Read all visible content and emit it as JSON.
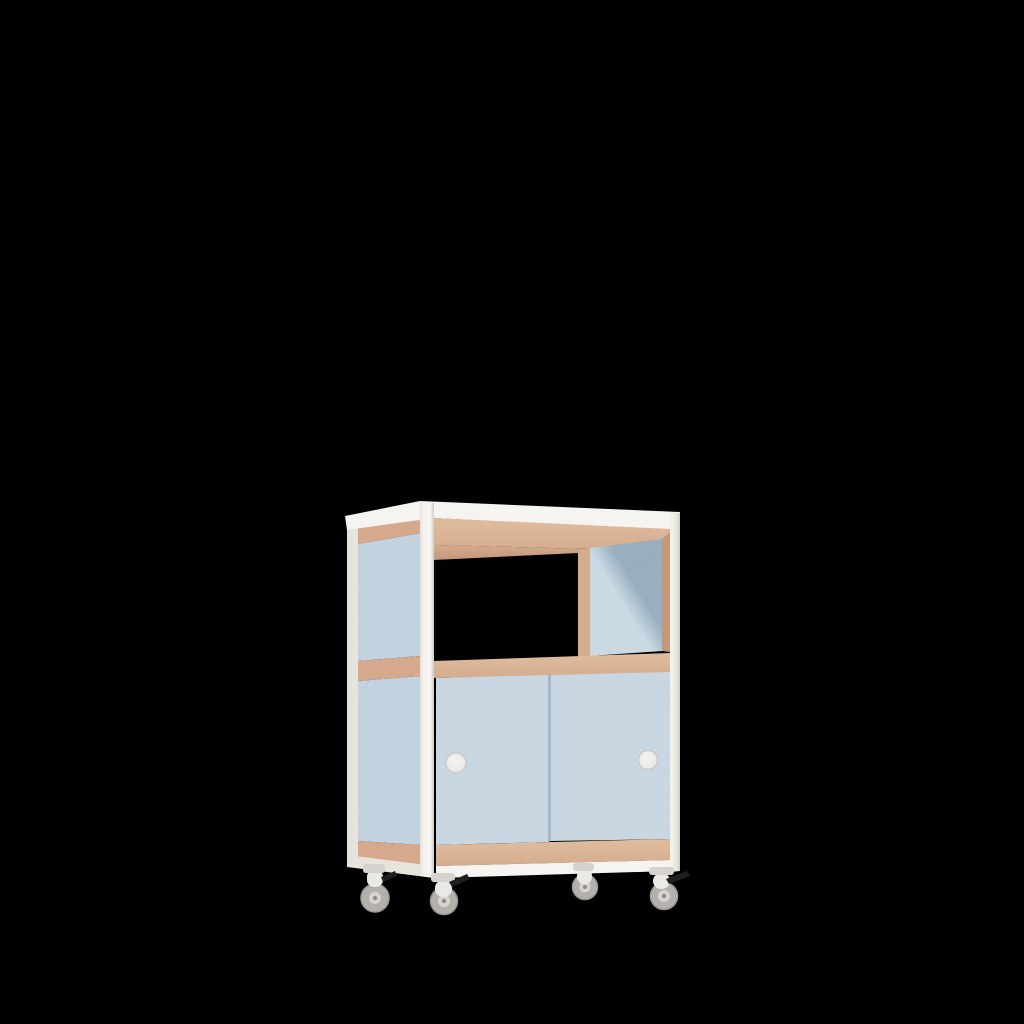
{
  "scene": {
    "background": "#000000",
    "object_name": "mobile cabinet with sliding doors on casters",
    "handle_count": 2,
    "caster_count": 4,
    "brake_count": 3
  },
  "colors": {
    "background": "#000000",
    "frame_white": "#f6f4f1",
    "frame_white_shade": "#e7e3dd",
    "frame_edge_dark": "#cfc9c1",
    "plywood_light": "#e0bda0",
    "plywood_mid": "#d5ac8e",
    "plywood_dark": "#c3977a",
    "plywood_side": "#d6a98c",
    "panel_side_blue": "#c3d3e0",
    "door_blue": "#c9d8e3",
    "door_gap": "#a4b7c4",
    "inner_panel_light": "#cadbe5",
    "inner_panel_dark": "#98afc0",
    "opening_black": "#010101",
    "handle_face": "#efedea",
    "handle_rim": "#ccc6bf",
    "caster_body": "#ebe9e6",
    "caster_body_shade": "#d6d2cd",
    "caster_wheel": "#b4b1ad",
    "caster_wheel_rim": "#9d9a96",
    "caster_hub": "#d8d5d1",
    "caster_axle": "#8f8c88",
    "brake_lever": "#1f1f1f"
  }
}
